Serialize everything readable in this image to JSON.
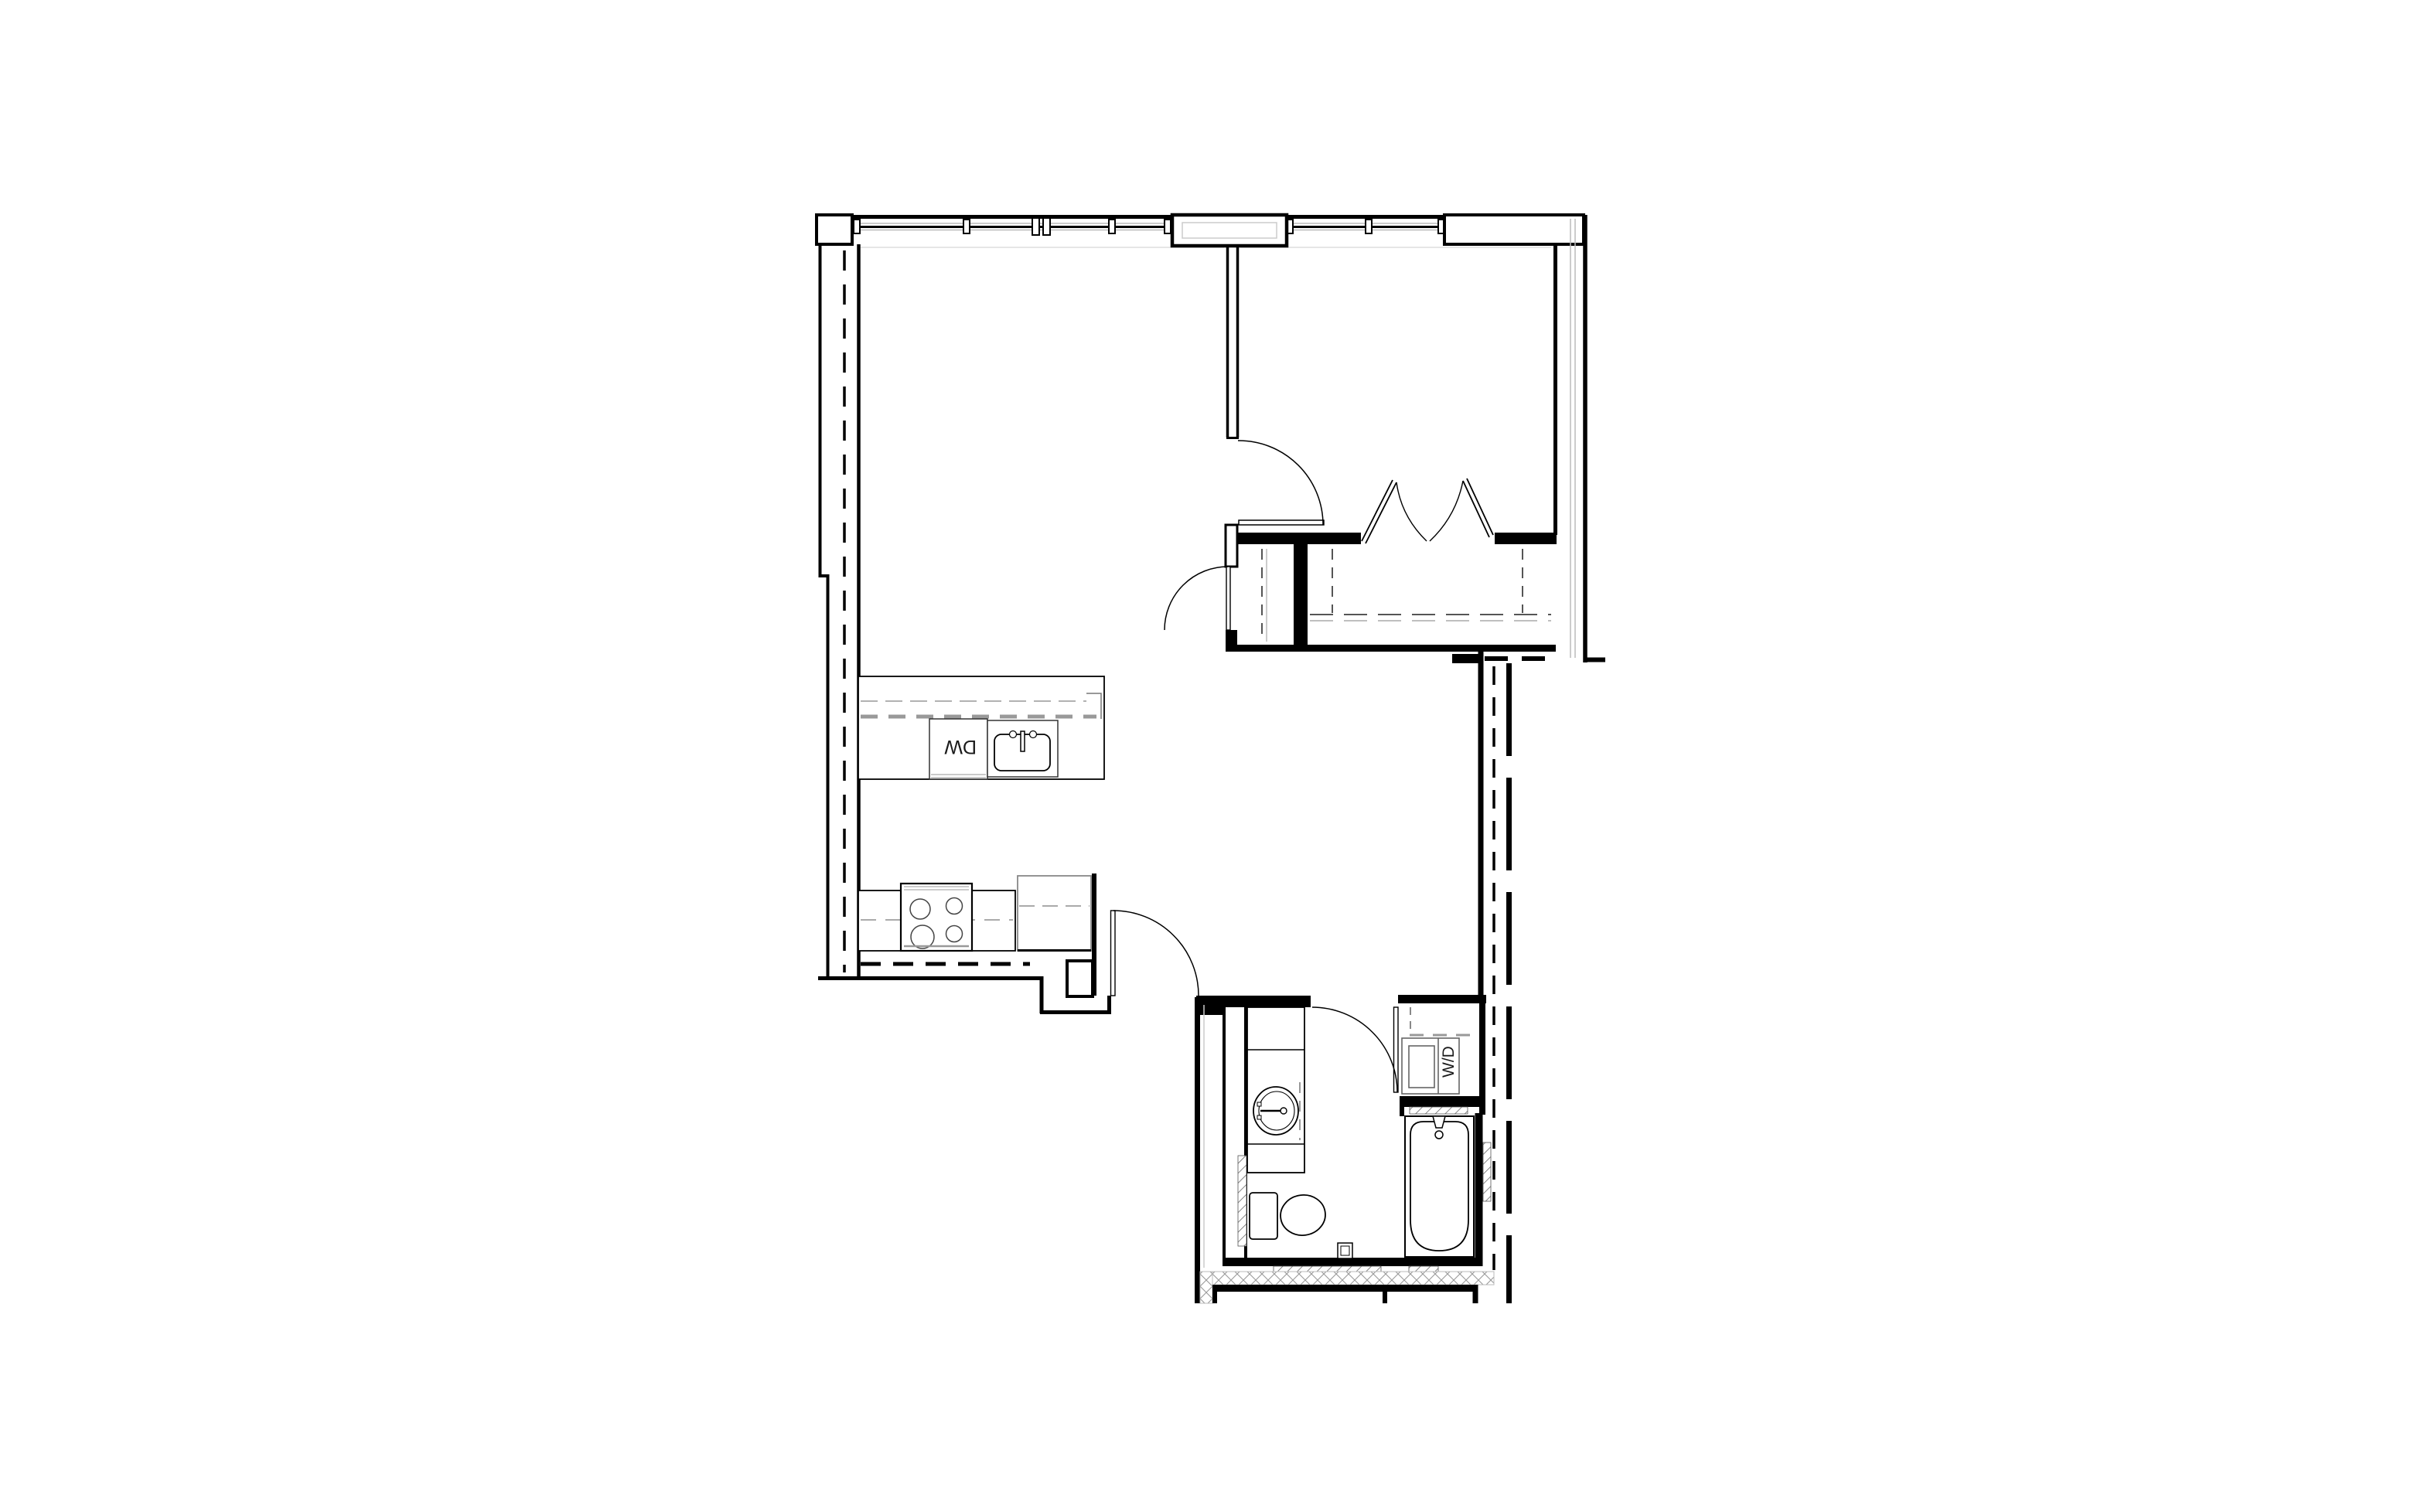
{
  "labels": {
    "dw": "DW",
    "wd": "W/D"
  },
  "colors": {
    "line": "#000000",
    "fixture_gray": "#777777",
    "light_gray": "#bbbbbb",
    "hatch": "#555555",
    "crosshatch": "#9a9a9a"
  },
  "plan": {
    "type": "apartment-unit-floor-plan",
    "fixtures": [
      "dishwasher",
      "kitchen-sink",
      "range",
      "refrigerator",
      "vanity-sink",
      "toilet",
      "bathtub",
      "washer-dryer",
      "bifold-closet-doors",
      "windows",
      "swing-doors"
    ]
  }
}
